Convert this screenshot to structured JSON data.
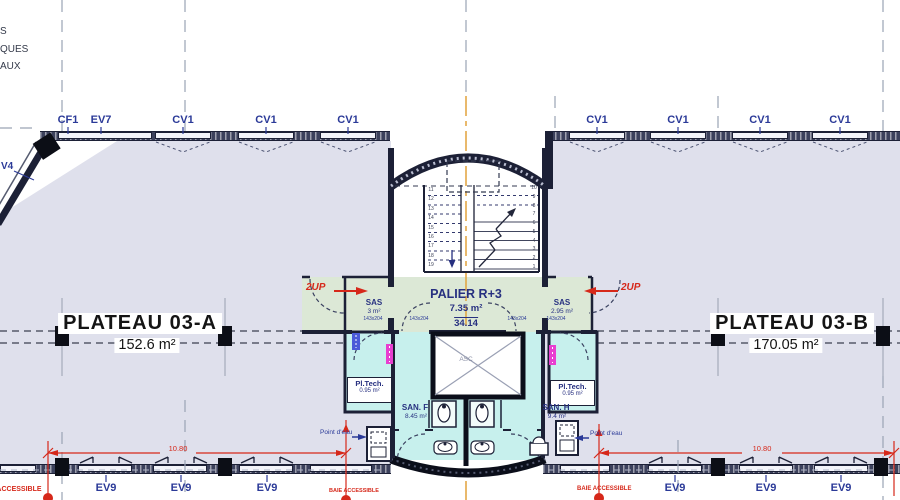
{
  "legend_cut": [
    "S",
    "QUES",
    "AUX"
  ],
  "facade_left_label": "V4",
  "top_labels": [
    "CF1",
    "EV7",
    "CV1",
    "CV1",
    "CV1",
    "CV1",
    "CV1",
    "CV1",
    "CV1"
  ],
  "ev9_labels": [
    "EV9",
    "EV9",
    "EV9",
    "EV9",
    "EV9",
    "EV9"
  ],
  "plateau_a": {
    "name": "PLATEAU 03-A",
    "area": "152.6 m²"
  },
  "plateau_b": {
    "name": "PLATEAU 03-B",
    "area": "170.05 m²"
  },
  "palier": {
    "name": "PALIER R+3",
    "area": "7.35 m²",
    "level": "34.14"
  },
  "sas_left": {
    "name": "SAS",
    "area": "3 m²"
  },
  "sas_right": {
    "name": "SAS",
    "area": "2.95 m²"
  },
  "pl_tech_left": {
    "name": "Pl.Tech.",
    "area": "0.95 m²"
  },
  "pl_tech_right": {
    "name": "Pl.Tech.",
    "area": "0.95 m²"
  },
  "san_f": {
    "name": "SAN. F",
    "area": "8.45 m²"
  },
  "san_h": {
    "name": "SAN. H",
    "area": "9.4 m²"
  },
  "elevator_label": "ASC",
  "door_size_labels": [
    "143x204",
    "143x204",
    "143x204",
    "143x204"
  ],
  "up_left": "2UP",
  "up_right": "2UP",
  "point_eau_left": "Point d'eau",
  "point_eau_right": "Point d'eau",
  "baie_labels": [
    "BAIE ACCESSIBLE",
    "BAIE ACCESSIBLE",
    "BAIE ACCESSIBLE"
  ],
  "dims": {
    "left": "10.80",
    "right": "10.80"
  },
  "stair": {
    "left_numbers": [
      "11",
      "12",
      "13",
      "14",
      "15",
      "16",
      "17",
      "18",
      "19"
    ],
    "right_numbers": [
      "10",
      "9",
      "8",
      "7",
      "6",
      "5",
      "4",
      "3",
      "2",
      "1"
    ]
  },
  "colors": {
    "wall": "#1c2036",
    "label_blue": "#2b3a98",
    "red": "#d6281a",
    "green": "#dce8d6",
    "cyan": "#c7f0ed",
    "floor": "#dfe0ec",
    "magenta": "#e83fd0",
    "axis_orange": "#e2a23c"
  }
}
